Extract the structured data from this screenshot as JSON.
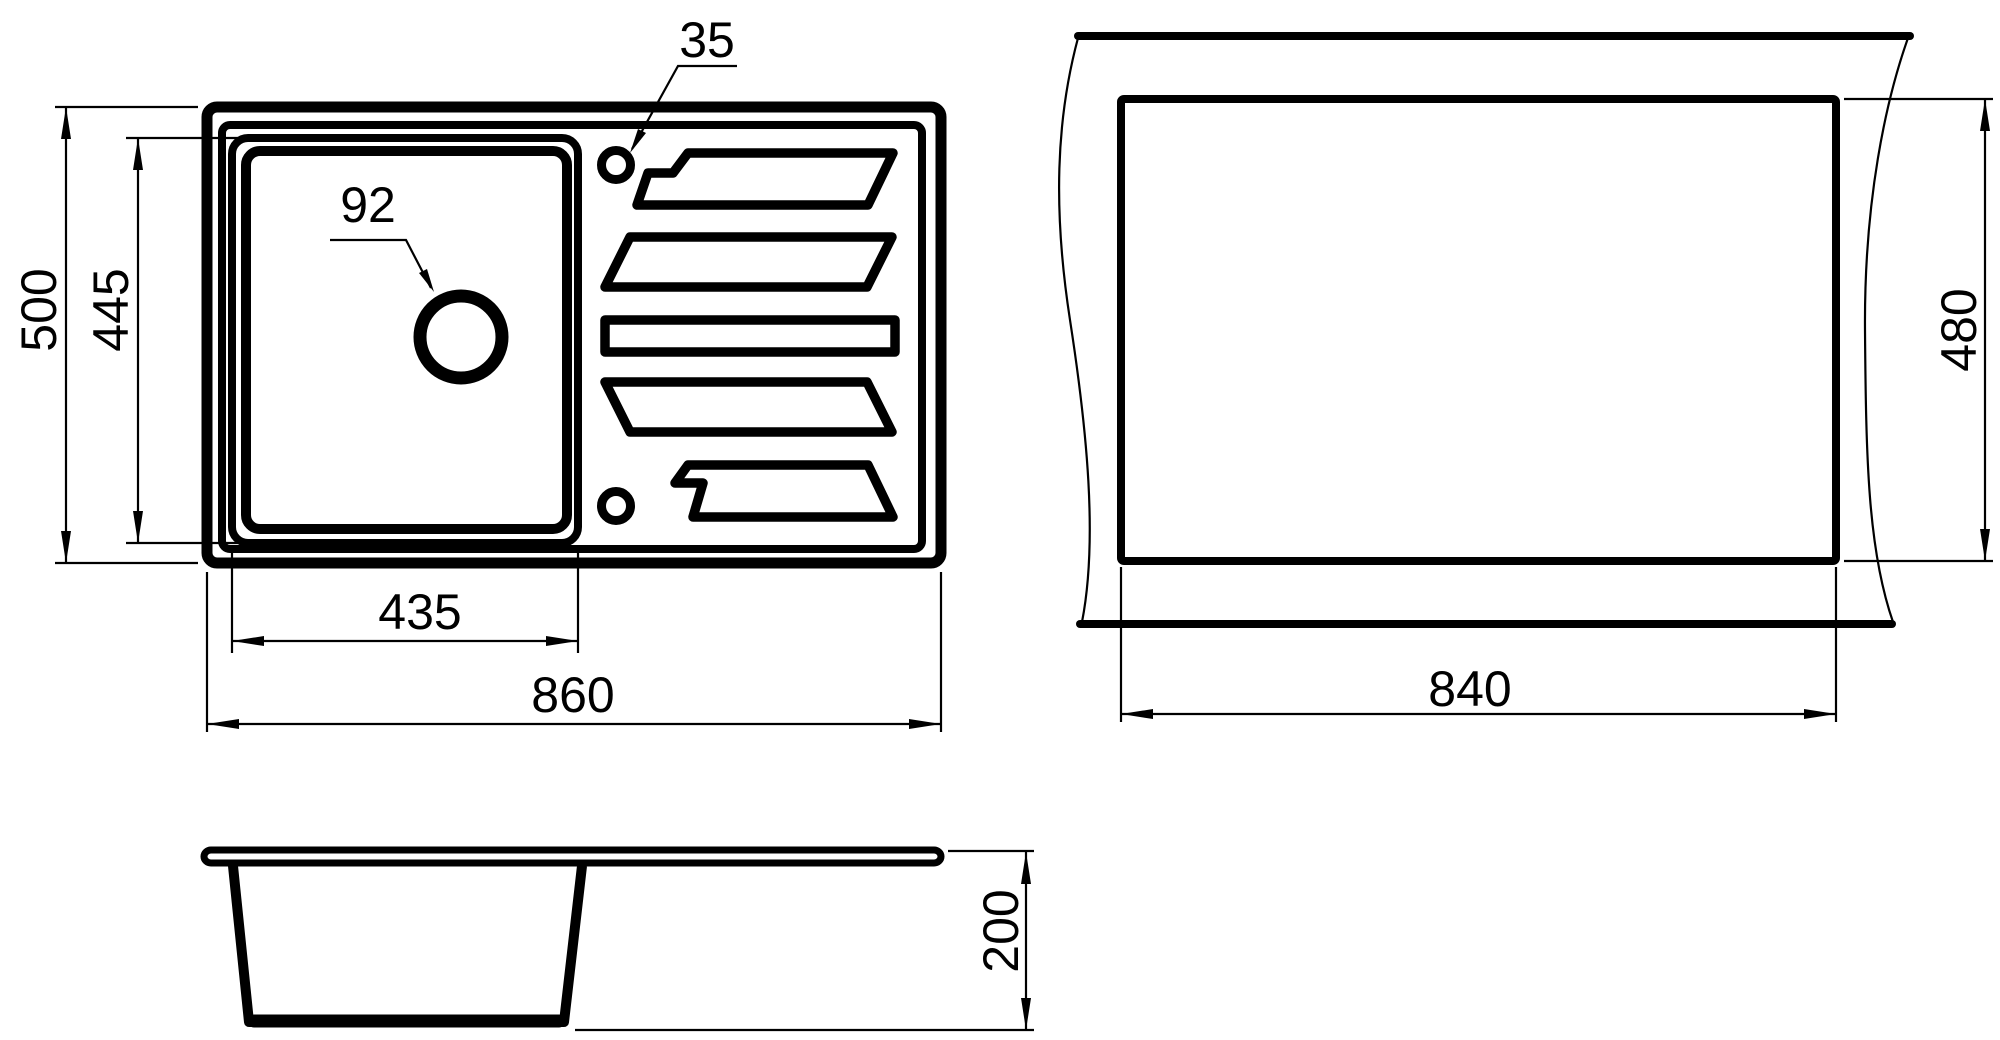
{
  "colors": {
    "line": "#000000",
    "background": "#ffffff"
  },
  "views": {
    "plan": {
      "outer_width": "860",
      "outer_height": "500",
      "bowl_width": "435",
      "bowl_height": "445",
      "drain_hole": "92",
      "tap_hole": "35"
    },
    "cutout": {
      "width": "840",
      "height": "480"
    },
    "side": {
      "depth": "200"
    }
  }
}
